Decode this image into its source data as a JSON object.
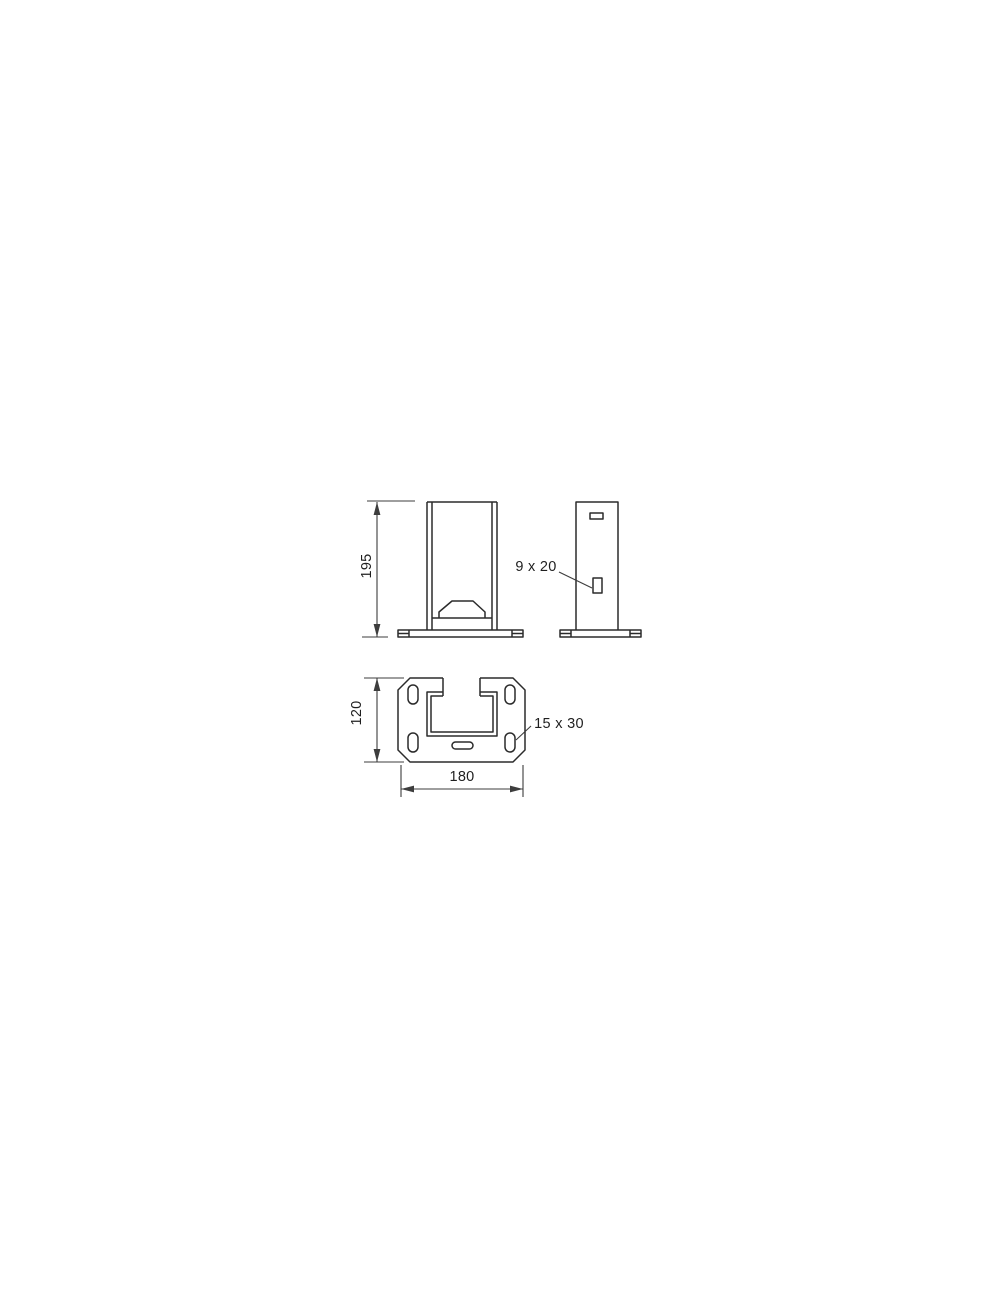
{
  "page": {
    "background": "#ffffff"
  },
  "drawing": {
    "type": "technical-drawing",
    "labels": {
      "height_dim": "195",
      "side_slot": "9 x 20",
      "plate_depth_dim": "120",
      "plate_width_dim": "180",
      "plate_slot": "15 x 30"
    },
    "colors": {
      "outline": "#2b2b2b",
      "dimension": "#3d3d3d",
      "text": "#1f1f1f"
    }
  }
}
